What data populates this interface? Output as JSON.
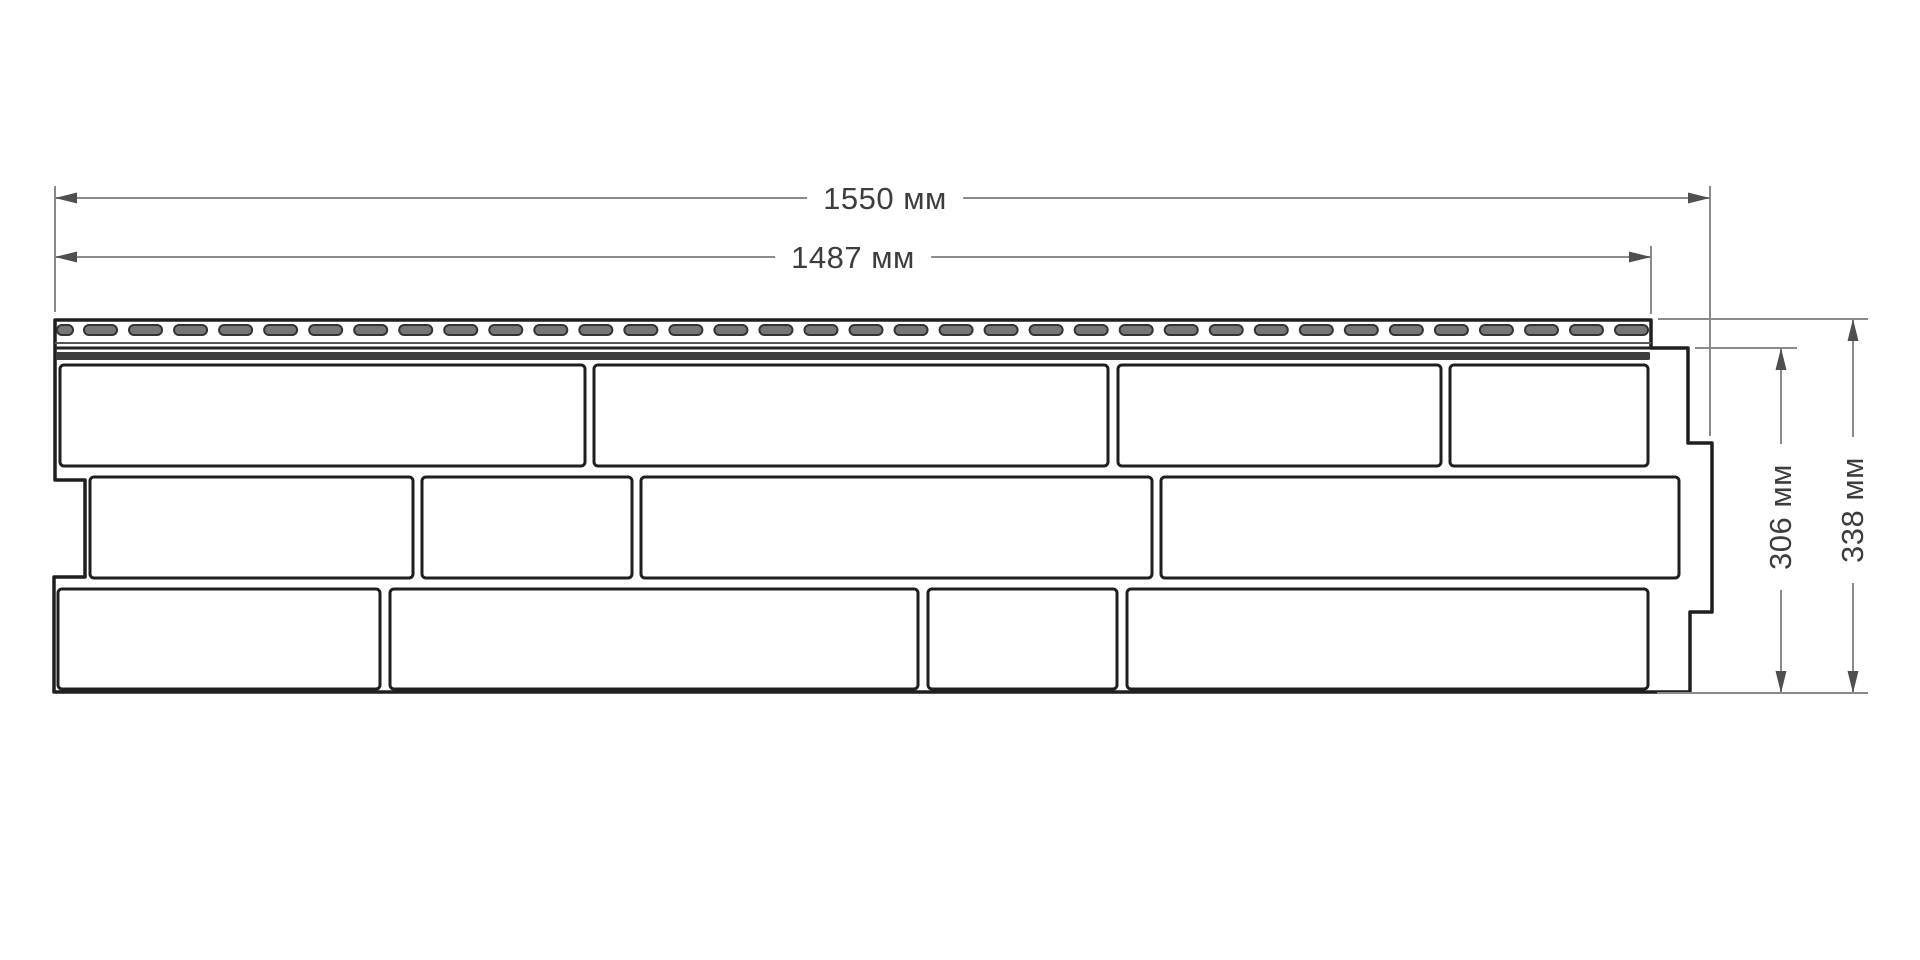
{
  "diagram": {
    "type": "technical-dimension-drawing",
    "subject": "Facade siding panel, front view with overall dimensions",
    "units": "мм"
  },
  "dimensions": {
    "total_width": {
      "value": 1550,
      "label": "1550 мм"
    },
    "nail_strip_width": {
      "value": 1487,
      "label": "1487 мм"
    },
    "body_height": {
      "value": 306,
      "label": "306 мм"
    },
    "total_height": {
      "value": 338,
      "label": "338 мм"
    }
  },
  "colors": {
    "background": "#ffffff",
    "outline": "#1f1f1f",
    "brick_fill": "#ffffff",
    "slot_fill": "#767676",
    "slot_stroke": "#333333",
    "strip_line_light": "#555555",
    "strip_line_dark": "#222222",
    "band_fill": "#3e3e3e",
    "dimension_line": "#8a8a8a",
    "arrow": "#4f4f4f",
    "label_text": "#3d3d3d"
  },
  "geometry": {
    "outline": [
      [
        55,
        320
      ],
      [
        1651,
        320
      ],
      [
        1651,
        348
      ],
      [
        1688,
        348
      ],
      [
        1688,
        443
      ],
      [
        1712,
        443
      ],
      [
        1712,
        612
      ],
      [
        1690,
        612
      ],
      [
        1690,
        692
      ],
      [
        54,
        692
      ],
      [
        54,
        577
      ],
      [
        85,
        577
      ],
      [
        85,
        480
      ],
      [
        55,
        480
      ]
    ],
    "strip": {
      "lines": [
        {
          "x1": 55,
          "x2": 1651,
          "y": 343,
          "w": 2,
          "tone": "light"
        },
        {
          "x1": 55,
          "x2": 1651,
          "y": 348,
          "w": 3,
          "tone": "dark"
        }
      ],
      "band": {
        "x1": 56,
        "x2": 1650,
        "y1": 352,
        "y2": 360
      },
      "slots": {
        "y": 325,
        "height": 10,
        "radius": 5,
        "first_x": 57,
        "first_width": 16,
        "full_start_x": 84,
        "full_width": 33,
        "pitch": 45.03,
        "full_count": 35
      }
    },
    "brick_rows": [
      {
        "y1": 365,
        "y2": 466,
        "bricks": [
          [
            60,
            585
          ],
          [
            594,
            1108
          ],
          [
            1118,
            1441
          ],
          [
            1450,
            1648
          ]
        ]
      },
      {
        "y1": 477,
        "y2": 578,
        "bricks": [
          [
            90,
            413
          ],
          [
            422,
            632
          ],
          [
            641,
            1152
          ],
          [
            1161,
            1679
          ]
        ]
      },
      {
        "y1": 589,
        "y2": 689,
        "bricks": [
          [
            58,
            380
          ],
          [
            390,
            918
          ],
          [
            928,
            1117
          ],
          [
            1127,
            1648
          ]
        ]
      }
    ],
    "extension_lines": [
      {
        "x1": 55,
        "y1": 186,
        "x2": 55,
        "y2": 312
      },
      {
        "x1": 1710,
        "y1": 186,
        "x2": 1710,
        "y2": 436
      },
      {
        "x1": 1651,
        "y1": 246,
        "x2": 1651,
        "y2": 314
      },
      {
        "x1": 1695,
        "y1": 348,
        "x2": 1797,
        "y2": 348
      },
      {
        "x1": 1658,
        "y1": 319,
        "x2": 1868,
        "y2": 319
      },
      {
        "x1": 1657,
        "y1": 693,
        "x2": 1868,
        "y2": 693
      }
    ],
    "dim_lines": [
      {
        "id": "total_width",
        "orient": "h",
        "y": 198,
        "x1": 55,
        "x2": 1710
      },
      {
        "id": "nail_strip_width",
        "orient": "h",
        "y": 257,
        "x1": 55,
        "x2": 1651
      },
      {
        "id": "body_height",
        "orient": "v",
        "x": 1781,
        "y1": 348,
        "y2": 693
      },
      {
        "id": "total_height",
        "orient": "v",
        "x": 1853,
        "y1": 319,
        "y2": 693
      }
    ],
    "arrow": {
      "length": 22,
      "half_width": 5.5
    }
  }
}
